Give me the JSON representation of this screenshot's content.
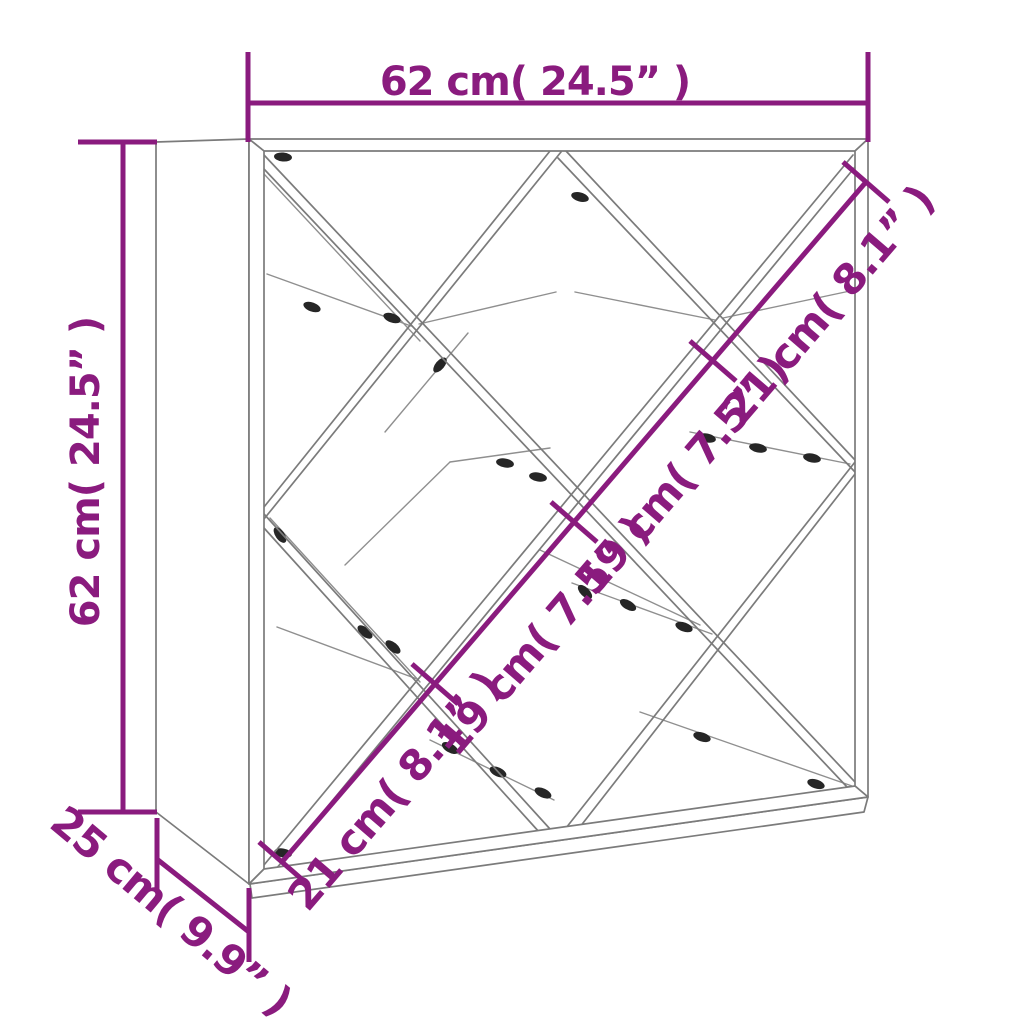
{
  "dimensions": {
    "width": "62 cm( 24.5” )",
    "height": "62 cm( 24.5” )",
    "depth": "25 cm( 9.9” )",
    "diagonal_segments": [
      "21 cm( 8.1” )",
      "19 cm( 7.5” )",
      "19 cm( 7.5” )",
      "21 cm( 8.1” )"
    ]
  },
  "colors": {
    "dimension_accent": "#8A1B7E",
    "outline_gray": "#7B7B7B",
    "detail_gray": "#8F8F8F",
    "screw_dark": "#262626",
    "background": "#FFFFFF"
  }
}
